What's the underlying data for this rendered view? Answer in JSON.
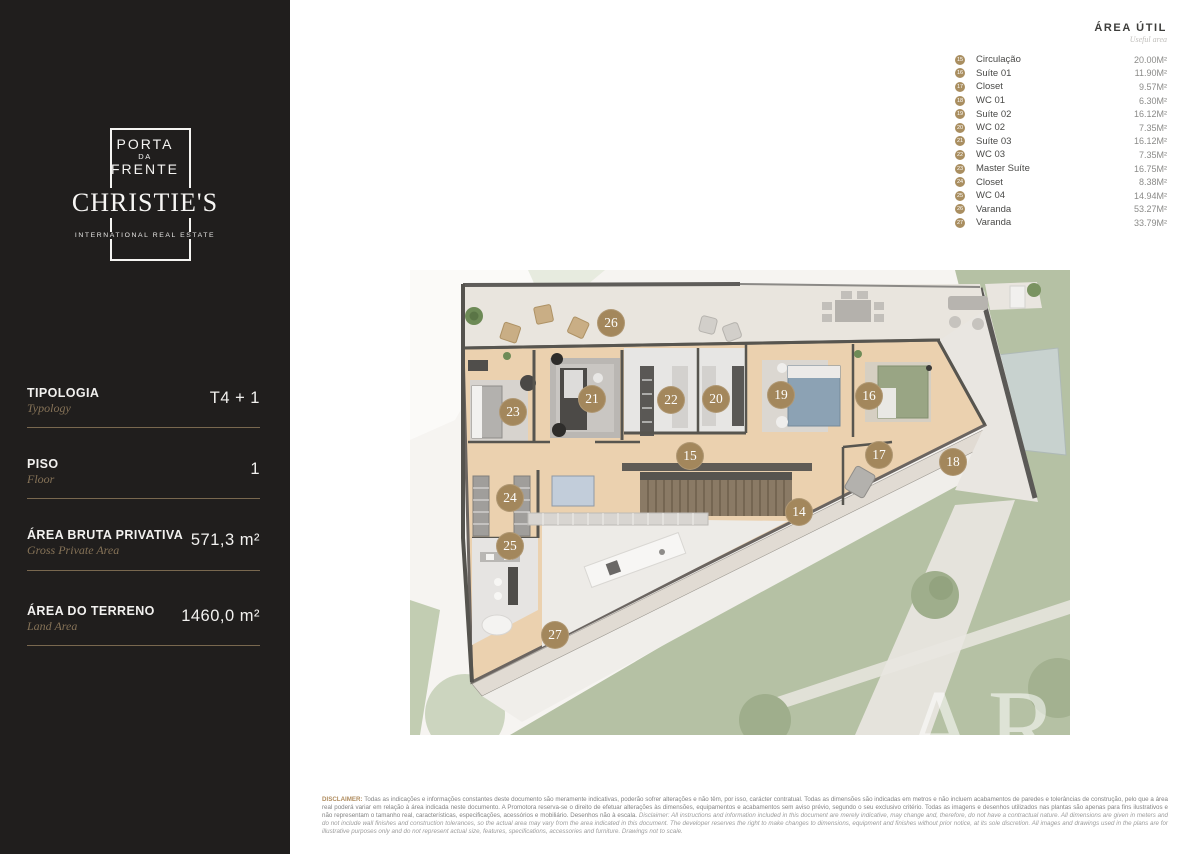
{
  "brand": {
    "logo_line1": "PORTA",
    "logo_line2": "DA",
    "logo_line3": "FRENTE",
    "name": "CHRISTIE'S",
    "tagline": "INTERNATIONAL REAL ESTATE"
  },
  "sidebar": {
    "rows": [
      {
        "label": "TIPOLOGIA",
        "sublabel": "Typology",
        "value": "T4 + 1"
      },
      {
        "label": "PISO",
        "sublabel": "Floor",
        "value": "1"
      },
      {
        "label": "ÁREA BRUTA PRIVATIVA",
        "sublabel": "Gross Private Area",
        "value": "571,3 m²"
      },
      {
        "label": "ÁREA DO TERRENO",
        "sublabel": "Land Area",
        "value": "1460,0 m²"
      }
    ]
  },
  "legend": {
    "title": "ÁREA ÚTIL",
    "subtitle": "Useful area",
    "items": [
      {
        "num": "15",
        "name": "Circulação",
        "area": "20.00M²"
      },
      {
        "num": "16",
        "name": "Suíte 01",
        "area": "11.90M²"
      },
      {
        "num": "17",
        "name": "Closet",
        "area": "9.57M²"
      },
      {
        "num": "18",
        "name": "WC 01",
        "area": "6.30M²"
      },
      {
        "num": "19",
        "name": "Suíte 02",
        "area": "16.12M²"
      },
      {
        "num": "20",
        "name": "WC 02",
        "area": "7.35M²"
      },
      {
        "num": "21",
        "name": "Suíte 03",
        "area": "16.12M²"
      },
      {
        "num": "22",
        "name": "WC 03",
        "area": "7.35M²"
      },
      {
        "num": "23",
        "name": "Master Suíte",
        "area": "16.75M²"
      },
      {
        "num": "24",
        "name": "Closet",
        "area": "8.38M²"
      },
      {
        "num": "25",
        "name": "WC 04",
        "area": "14.94M²"
      },
      {
        "num": "26",
        "name": "Varanda",
        "area": "53.27M²"
      },
      {
        "num": "27",
        "name": "Varanda",
        "area": "33.79M²"
      }
    ]
  },
  "plan": {
    "watermark": "ARE",
    "markers": [
      {
        "num": "14",
        "x": 389,
        "y": 242
      },
      {
        "num": "15",
        "x": 280,
        "y": 186
      },
      {
        "num": "16",
        "x": 459,
        "y": 126
      },
      {
        "num": "17",
        "x": 469,
        "y": 185
      },
      {
        "num": "18",
        "x": 543,
        "y": 192
      },
      {
        "num": "19",
        "x": 371,
        "y": 125
      },
      {
        "num": "20",
        "x": 306,
        "y": 129
      },
      {
        "num": "21",
        "x": 182,
        "y": 129
      },
      {
        "num": "22",
        "x": 261,
        "y": 130
      },
      {
        "num": "23",
        "x": 103,
        "y": 142
      },
      {
        "num": "24",
        "x": 100,
        "y": 228
      },
      {
        "num": "25",
        "x": 100,
        "y": 276
      },
      {
        "num": "26",
        "x": 201,
        "y": 53
      },
      {
        "num": "27",
        "x": 145,
        "y": 365
      }
    ]
  },
  "disclaimer": {
    "prefix": "DISCLAIMER:",
    "pt": " Todas as indicações e informações constantes deste documento são meramente indicativas, poderão sofrer alterações e não têm, por isso, carácter contratual. Todas as dimensões são indicadas em metros e não incluem acabamentos de paredes e tolerâncias de construção, pelo que a área real poderá variar em relação à área indicada neste documento. A Promotora reserva-se o direito de efetuar alterações às dimensões, equipamentos e acabamentos sem aviso prévio, segundo o seu exclusivo critério. Todas as imagens e desenhos utilizados nas plantas são apenas para fins ilustrativos e não representam o tamanho real, características, especificações, acessórios e mobiliário. Desenhos não à escala. ",
    "en": "Disclaimer: All instructions and information included in this document are merely indicative, may change and, therefore, do not have a contractual nature. All dimensions are given in meters and do not include wall finishes and construction tolerances, so the actual area may vary from the area indicated in this document. The developer reserves the right to make changes to dimensions, equipment and finishes without prior notice, at its sole discretion. All images and drawings used in the plans are for illustrative purposes only and do not represent actual size, features, specifications, accessories and furniture. Drawings not to scale."
  },
  "colors": {
    "sidebar_bg": "#201e1d",
    "accent_gold": "#a3875c",
    "divider_gold": "#79684f",
    "lawn_green": "#b5c1a4",
    "wood_floor": "#ebd1af",
    "pool_blue": "#c8d2cf"
  }
}
